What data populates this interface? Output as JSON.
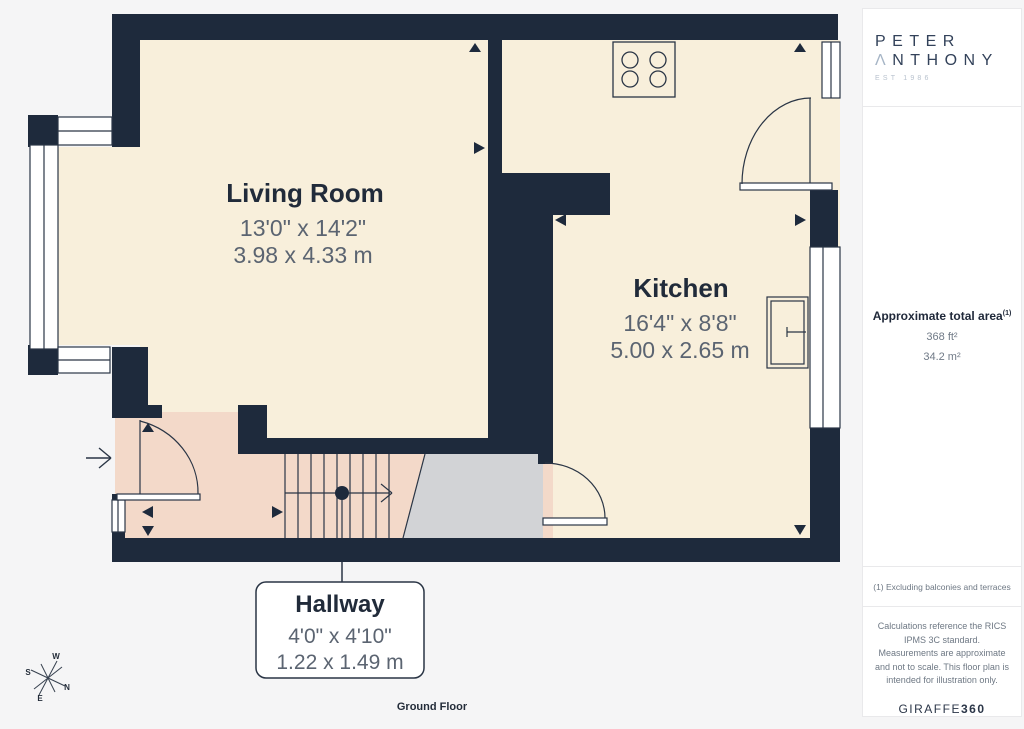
{
  "floorplan": {
    "title": "Ground Floor",
    "rooms": [
      {
        "name": "Living Room",
        "dimensions_ft": "13'0\" x 14'2\"",
        "dimensions_m": "3.98 x 4.33 m"
      },
      {
        "name": "Kitchen",
        "dimensions_ft": "16'4\" x 8'8\"",
        "dimensions_m": "5.00 x 2.65 m"
      },
      {
        "name": "Hallway",
        "dimensions_ft": "4'0\" x 4'10\"",
        "dimensions_m": "1.22 x 1.49 m"
      }
    ],
    "compass": {
      "n": "N",
      "s": "S",
      "e": "E",
      "w": "W"
    }
  },
  "sidebar": {
    "logo": {
      "line1": "PETER",
      "line2_initial": "Λ",
      "line2_rest": "NTHONY",
      "est": "EST 1986"
    },
    "area": {
      "heading": "Approximate total area",
      "superscript": "(1)",
      "imperial": "368 ft²",
      "metric": "34.2 m²"
    },
    "note": "(1) Excluding balconies and terraces",
    "disclaimer": "Calculations reference the RICS IPMS 3C standard. Measurements are approximate and not to scale. This floor plan is intended for illustration only.",
    "brand": {
      "name": "GIRAFFE",
      "suffix": "360"
    }
  },
  "colors": {
    "wall": "#1e2a3c",
    "room_floor": "#f8efdb",
    "hallway_floor": "#f3d9c9",
    "stairs_floor": "#d2d3d6",
    "line": "#2a3545",
    "logo_navy": "#33425a",
    "logo_accent": "#a6b5c6"
  }
}
